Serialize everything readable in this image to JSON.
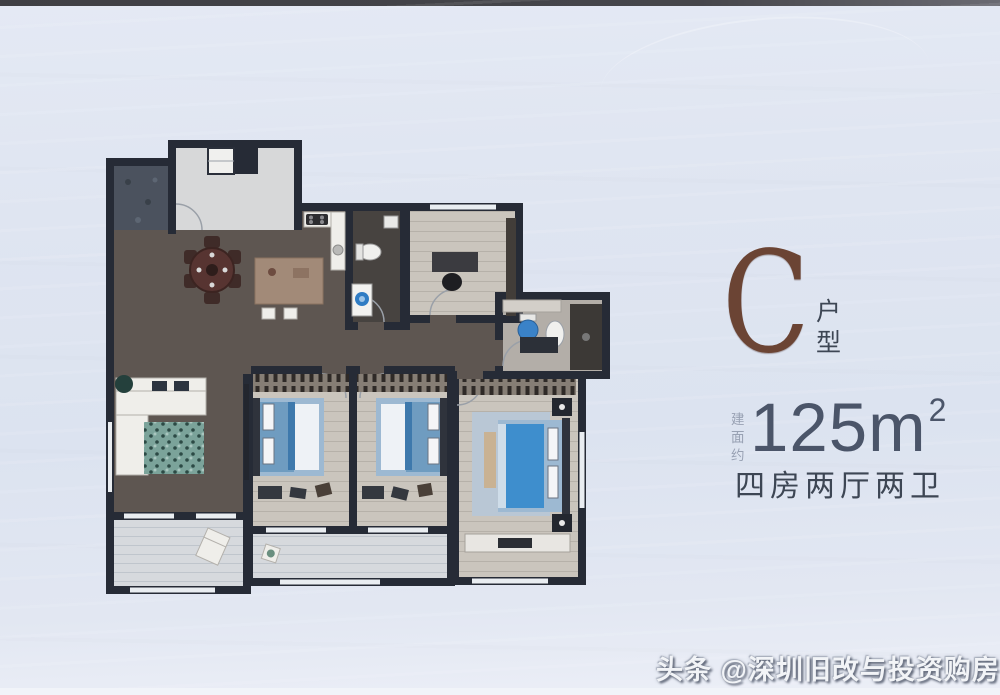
{
  "unit": {
    "letter": "C",
    "type_label": "户型",
    "area_prefix": "建面约",
    "area_value": "125m",
    "area_sup": "2",
    "layout_label": "四房两厅两卫"
  },
  "watermark": {
    "text": "头条 @深圳旧改与投资购房"
  },
  "colors": {
    "photo_top_strip": "#46464b",
    "wall": "#262b36",
    "floor_dark": "#5e5651",
    "floor_light": "#c9c4bc",
    "balcony_floor": "#d6d9dd",
    "bath_floor": "#474340",
    "bed_blue": "#6f9cc0",
    "bed_blue_dark": "#3e79ac",
    "master_bed_blue": "#3e8ecd",
    "toilet_blue": "#3a82c8",
    "rug_teal": "#7ba39a",
    "island_brown": "#a28a78",
    "accent_brown": "#6b4434",
    "text_primary": "#4b5569",
    "text_secondary": "#3d4654",
    "text_muted": "#98a1b3",
    "watermark_color": "#f2f4f7"
  }
}
